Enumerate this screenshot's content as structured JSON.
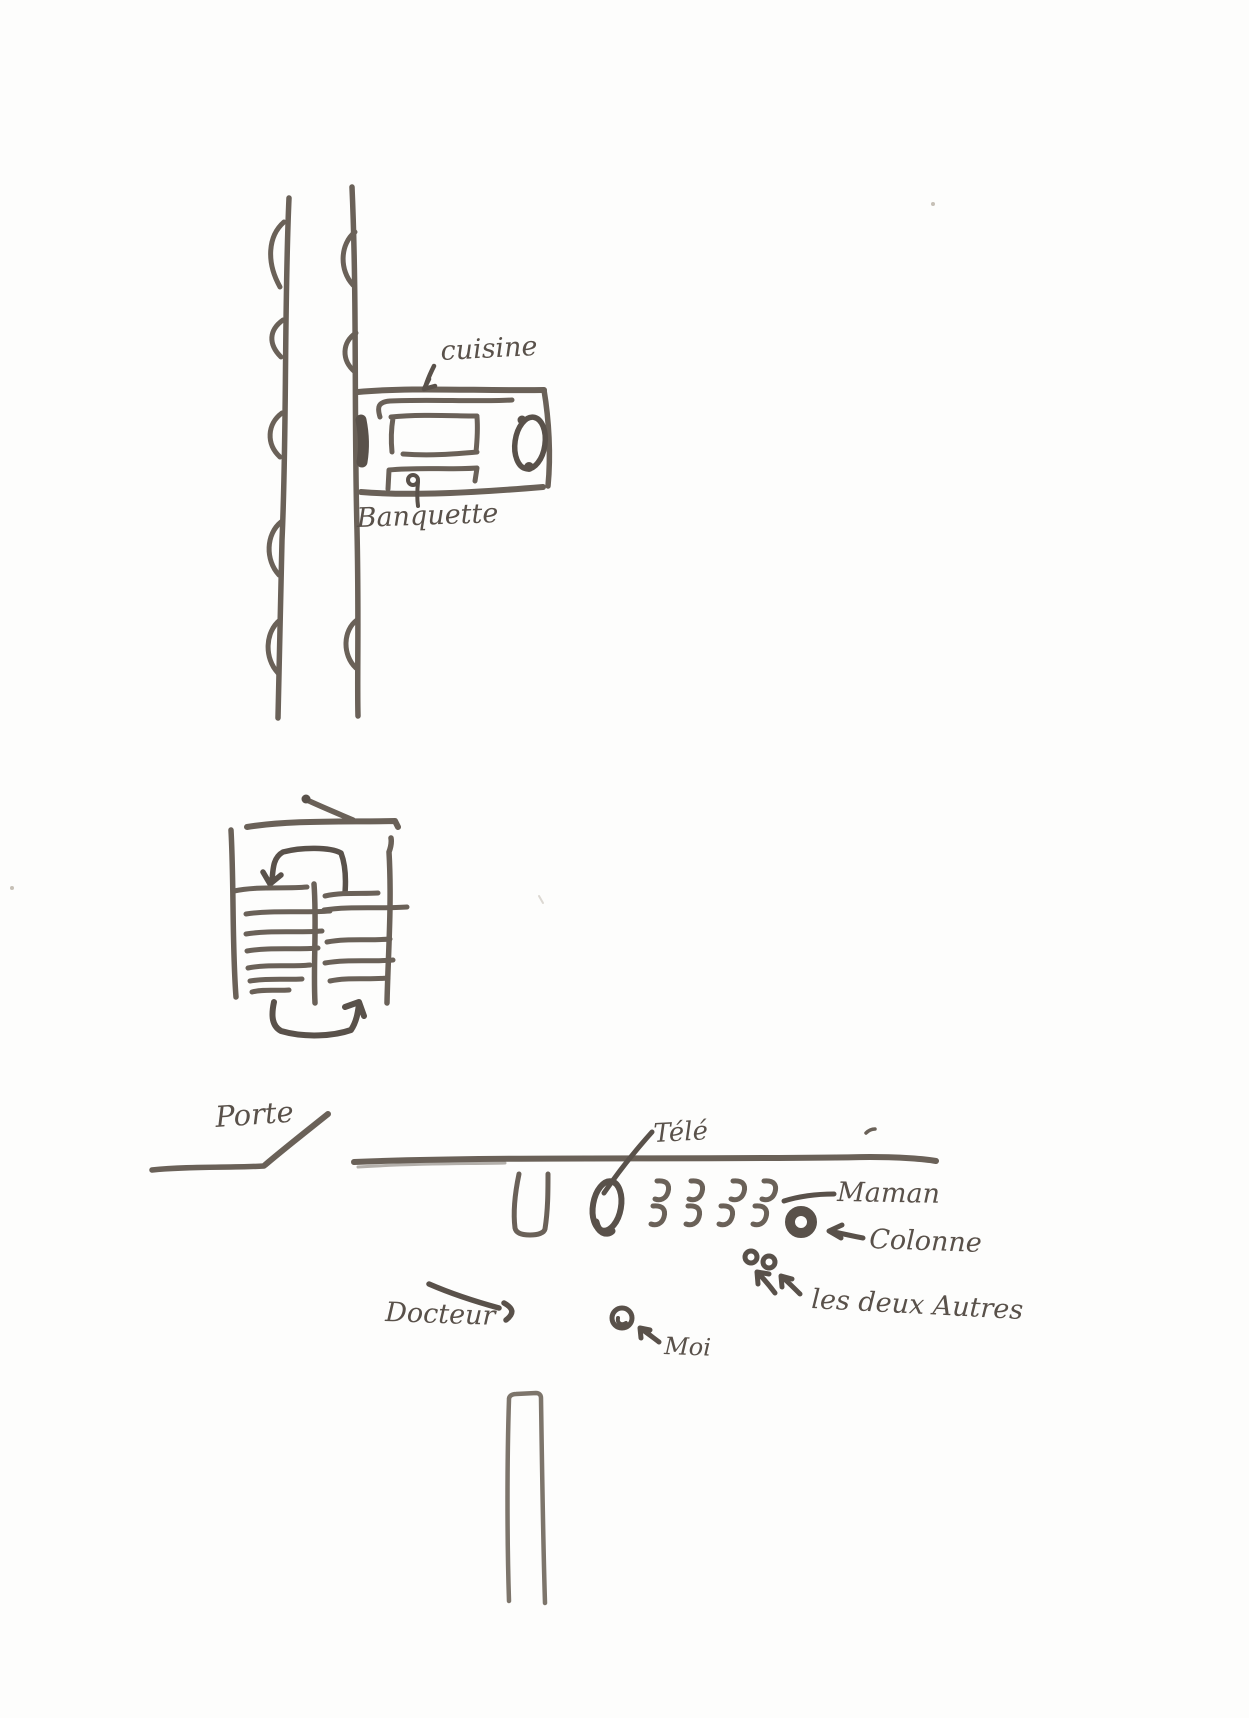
{
  "document": {
    "type": "hand-drawn floor plan sketch",
    "language": "French"
  },
  "colors": {
    "ink": "#6a6158",
    "ink-dark": "#59514a",
    "ink-light": "#7d756b",
    "paper": "#fdfdfc"
  },
  "labels": {
    "cuisine": "cuisine",
    "banquette": "Banquette",
    "porte": "Porte",
    "tele": "Télé",
    "maman": "Maman",
    "colonne": "Colonne",
    "les_deux_autres": "les deux Autres",
    "docteur": "Docteur",
    "moi": "Moi"
  }
}
